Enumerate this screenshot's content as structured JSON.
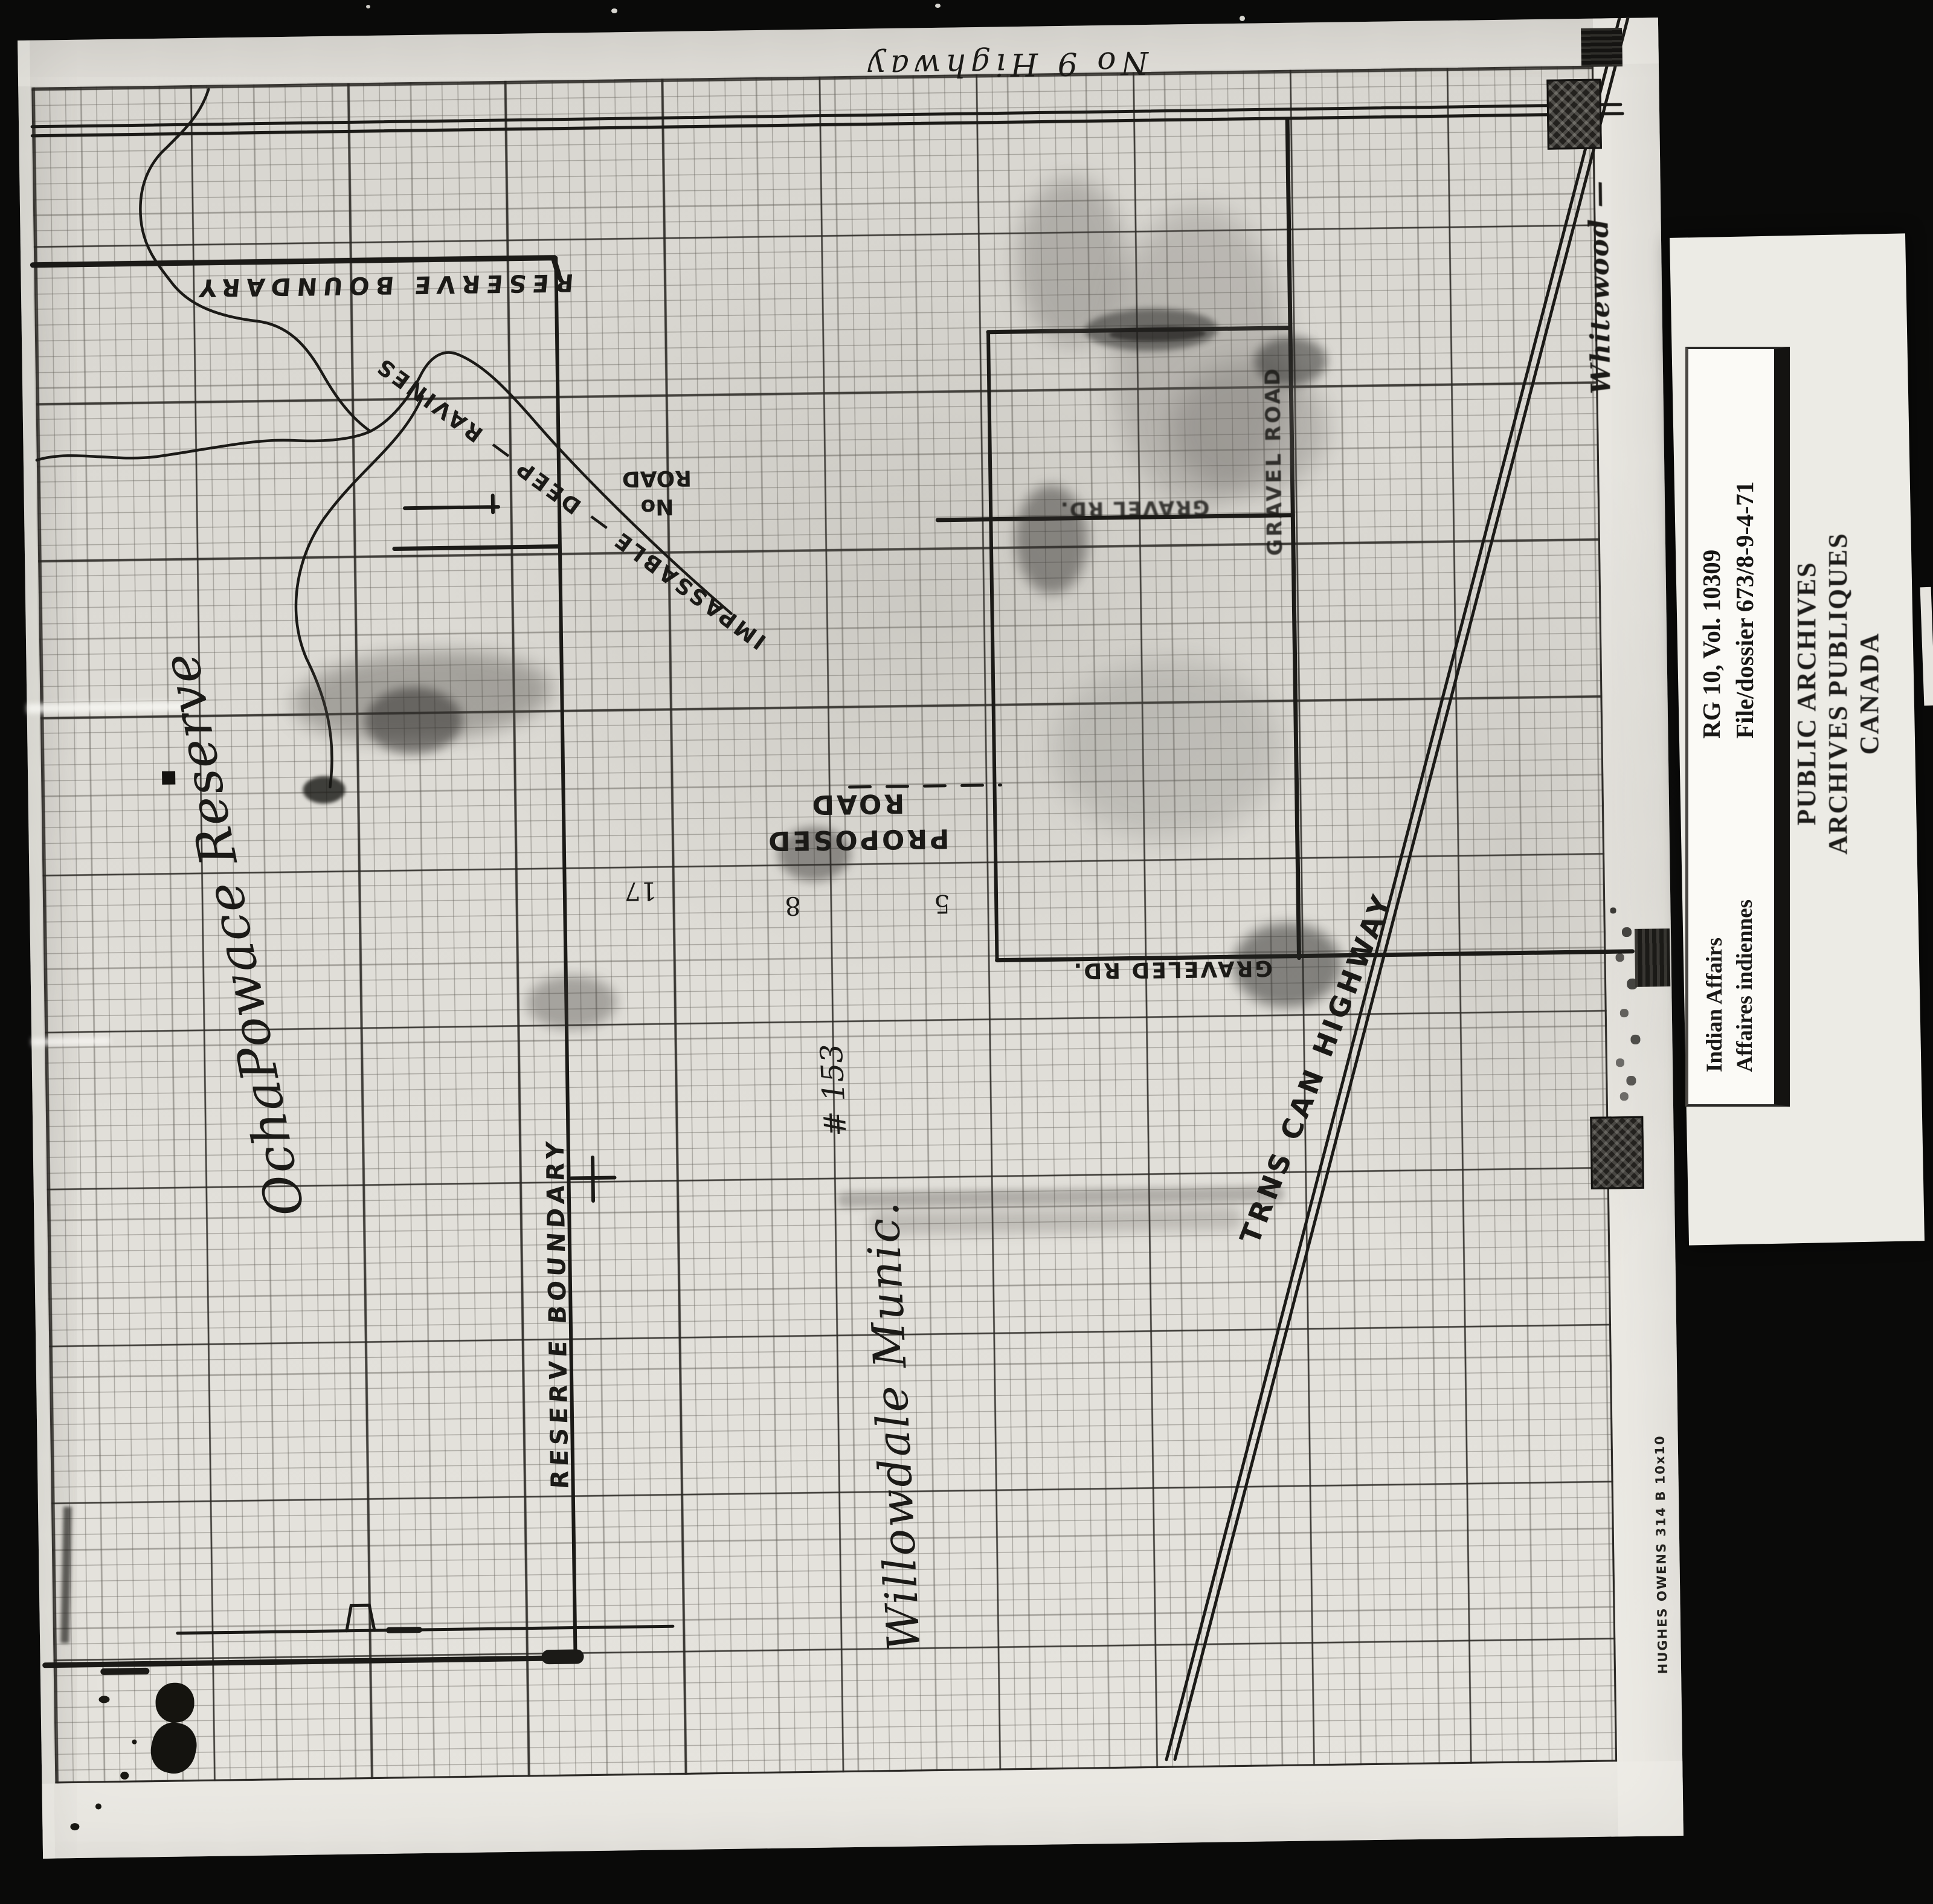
{
  "map": {
    "highway9": "No 9 Highway",
    "reserve_boundary_top": "RESERVE BOUNDARY",
    "reserve_name": "OchaPowace Reserve",
    "ravines": "IMPASSABLE — DEEP — RAVINES",
    "no_road": {
      "line1": "No",
      "line2": "ROAD"
    },
    "proposed_road": {
      "line1": "PROPOSED",
      "line2": "ROAD"
    },
    "sections": {
      "n17": "17",
      "n8": "8",
      "n5": "5"
    },
    "gravel_rd": "GRAVEL RD.",
    "gravel_road_vertical": "GRAVEL ROAD",
    "graveled_rd": "GRAVELED RD.",
    "trans_canada": "TRNS CAN HIGHWAY",
    "municipality": {
      "number": "# 153",
      "name": "Willowdale Munic."
    },
    "reserve_boundary_side": "RESERVE BOUNDARY",
    "whitewood": "Whitewood —",
    "paper_brand": "HUGHES OWENS 314 B 10x10"
  },
  "archive": {
    "stamp": {
      "line1": "PUBLIC ARCHIVES",
      "line2": "ARCHIVES PUBLIQUES",
      "line3": "CANADA"
    },
    "label": {
      "department_en": "Indian Affairs",
      "department_fr": "Affaires indiennes",
      "reference": "RG 10, Vol. 10309",
      "file": "File/dossier 673/8-9-4-71"
    }
  }
}
